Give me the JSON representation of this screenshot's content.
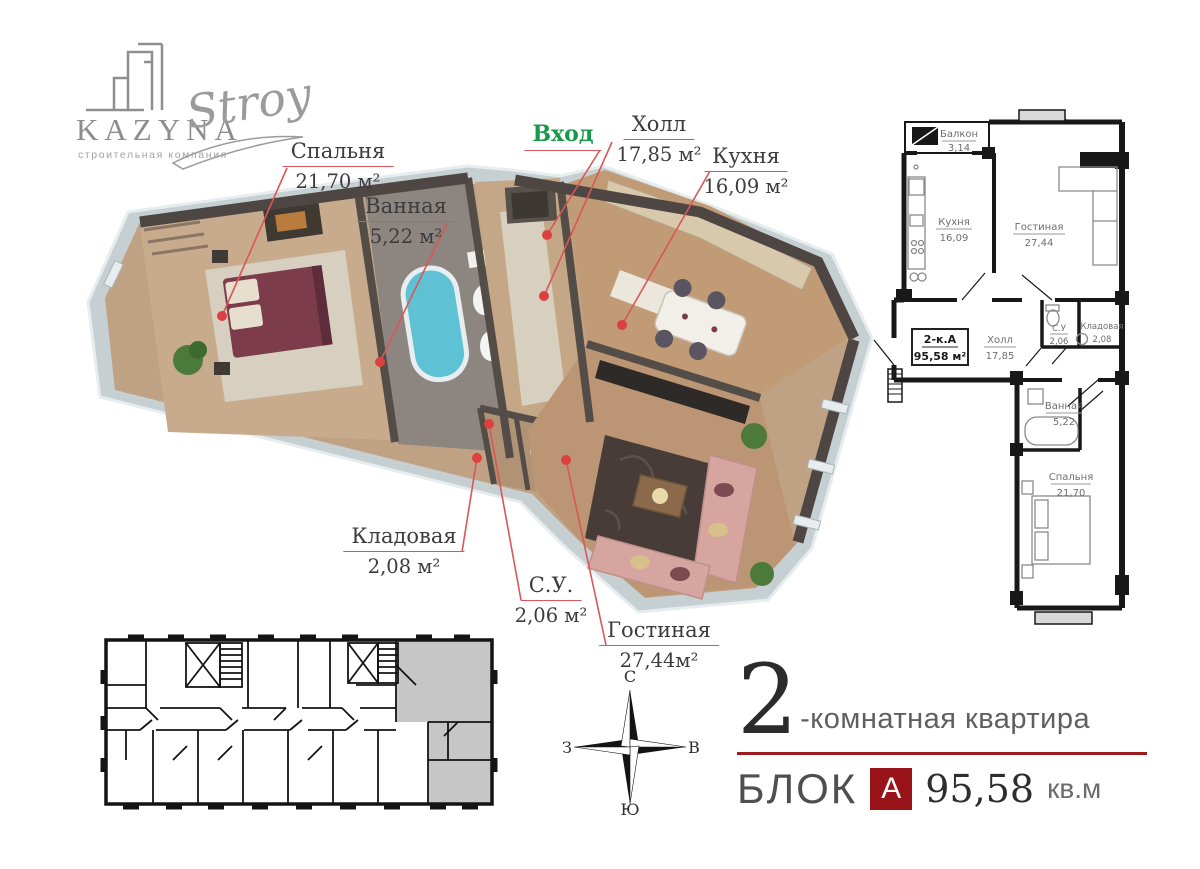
{
  "logo": {
    "brand": "KAZYNA",
    "brand_script": "Stroy",
    "tagline": "строительная компания"
  },
  "plan3d": {
    "entry_label": "Вход",
    "rooms": [
      {
        "name": "Спальня",
        "area": "21,70 м²"
      },
      {
        "name": "Ванная",
        "area": "5,22 м²"
      },
      {
        "name": "Холл",
        "area": "17,85 м²"
      },
      {
        "name": "Кухня",
        "area": "16,09 м²"
      },
      {
        "name": "Кладовая",
        "area": "2,08 м²"
      },
      {
        "name": "С.У.",
        "area": "2,06 м²"
      },
      {
        "name": "Гостиная",
        "area": "27,44м²"
      }
    ]
  },
  "plan2d": {
    "unit_code": "2-к.А",
    "unit_area": "95,58 м²",
    "rooms": [
      {
        "name": "Балкон",
        "area": "3,14"
      },
      {
        "name": "Кухня",
        "area": "16,09"
      },
      {
        "name": "Гостиная",
        "area": "27,44"
      },
      {
        "name": "Холл",
        "area": "17,85"
      },
      {
        "name": "С.У",
        "area": "2,06"
      },
      {
        "name": "Кладовая",
        "area": "2,08"
      },
      {
        "name": "Ванная",
        "area": "5,22"
      },
      {
        "name": "Спальня",
        "area": "21,70"
      }
    ]
  },
  "compass": {
    "north": "С",
    "east": "В",
    "south": "Ю",
    "west": "З"
  },
  "title": {
    "rooms_count": "2",
    "rooms_label": "-комнатная квартира",
    "block_word": "БЛОК",
    "block_letter": "А",
    "area_value": "95,58",
    "area_unit": "кв.м"
  },
  "colors": {
    "accent_red": "#9b1b1e",
    "leader_red": "#d95757",
    "entry_green": "#169a4a",
    "highlight_gray": "#c6c6c6"
  }
}
